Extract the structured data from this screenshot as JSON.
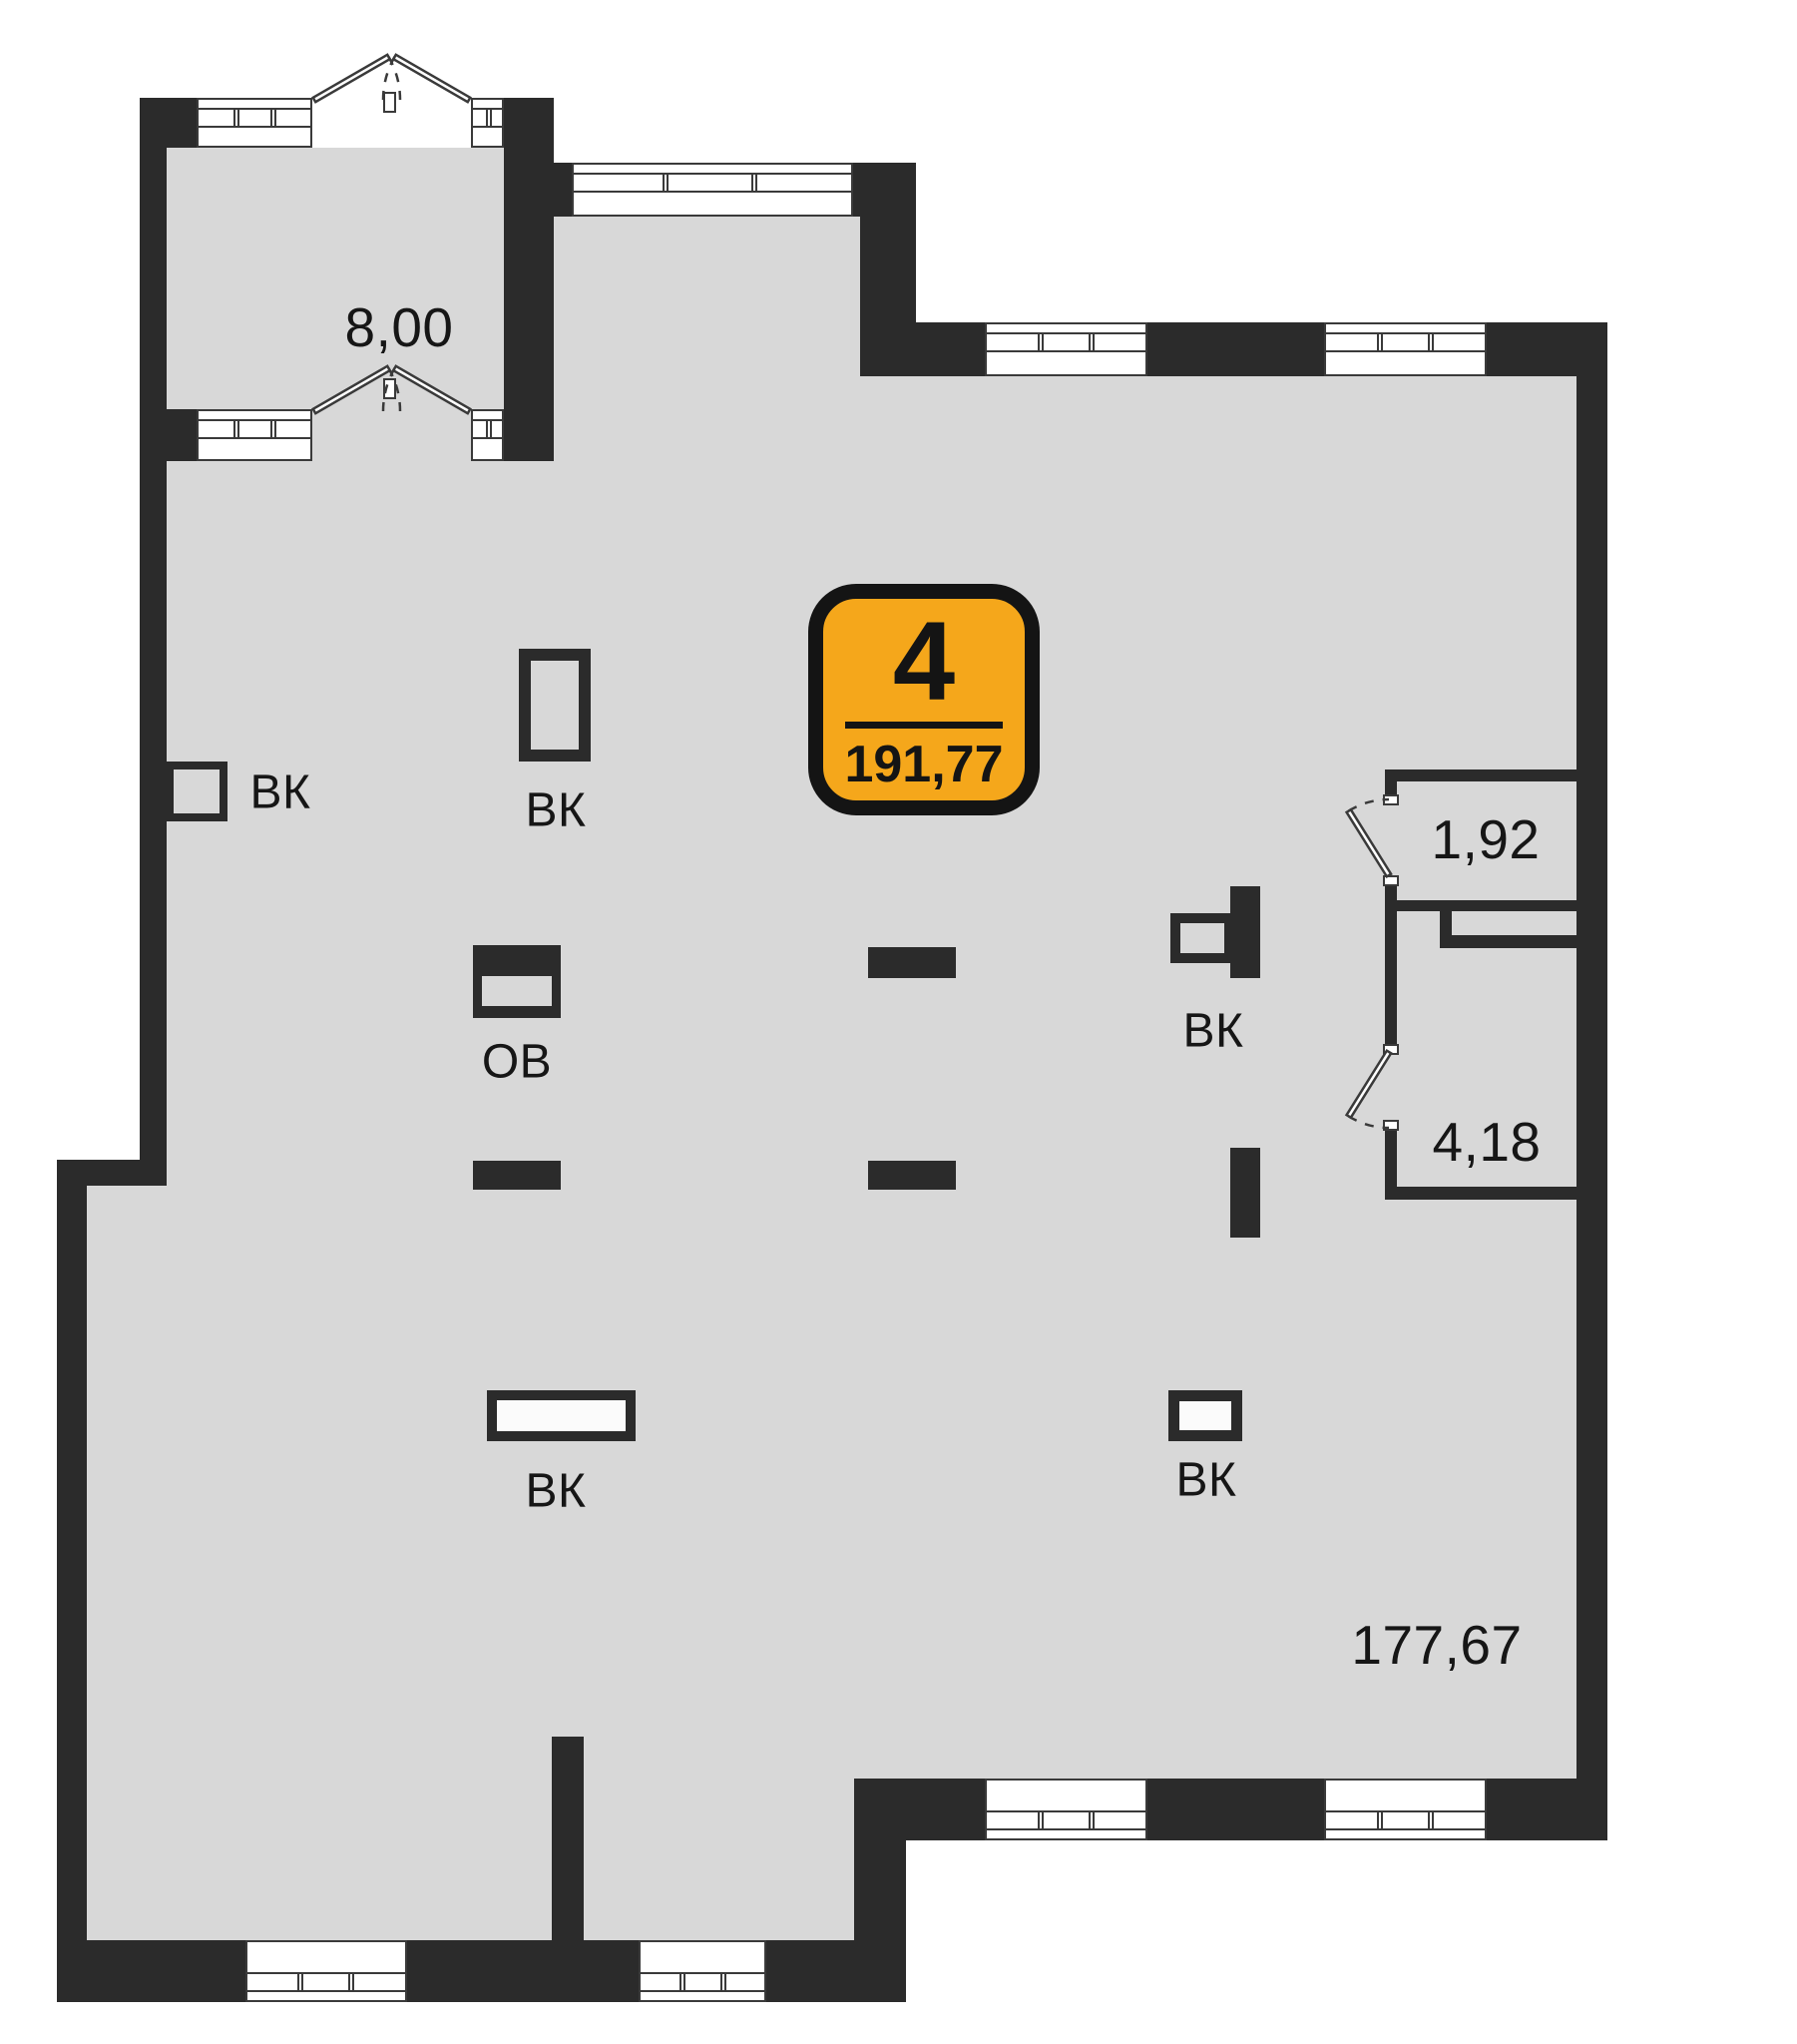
{
  "badge": {
    "rooms_count": "4",
    "area": "191,77"
  },
  "areas": {
    "balcony": "8,00",
    "small_room_1": "1,92",
    "small_room_2": "4,18",
    "main_room": "177,67"
  },
  "markers": {
    "vk_left": "ВК",
    "vk_shaft": "ВК",
    "ov": "ОВ",
    "vk_right": "ВК",
    "vk_bottom_left": "ВК",
    "vk_bottom_right": "ВК"
  },
  "colors": {
    "wall": "#2b2b2b",
    "floor": "#d8d8d8",
    "line": "#3a3a3a",
    "badge_fill": "#F5A71B",
    "badge_border": "#141414"
  }
}
